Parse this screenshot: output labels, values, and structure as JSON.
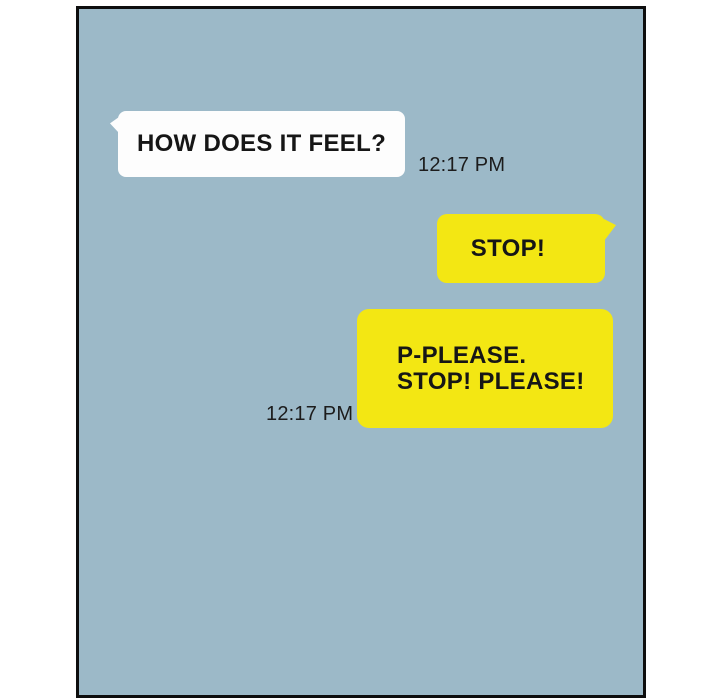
{
  "panel": {
    "type": "comic-chat-panel",
    "colors": {
      "page_background": "#ffffff",
      "panel_background": "#9cb9c8",
      "panel_border": "#0e0e0e",
      "bubble_incoming": "#fdfdfd",
      "bubble_outgoing": "#f3e713",
      "text": "#161616"
    }
  },
  "chat": {
    "messages": [
      {
        "sender": "left",
        "text": "HOW DOES IT FEEL?",
        "time": "12:17 PM"
      },
      {
        "sender": "right",
        "text": "STOP!"
      },
      {
        "sender": "right",
        "lines": [
          "P-PLEASE.",
          "STOP! PLEASE!"
        ],
        "time": "12:17 PM"
      }
    ]
  }
}
